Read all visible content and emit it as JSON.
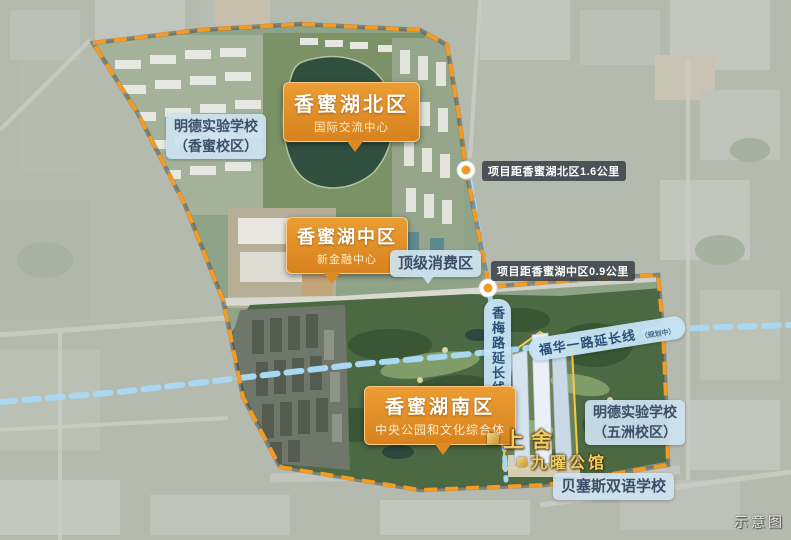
{
  "districts": {
    "north": {
      "title": "香蜜湖北区",
      "subtitle": "国际交流中心"
    },
    "middle": {
      "title": "香蜜湖中区",
      "subtitle": "新金融中心"
    },
    "south": {
      "title": "香蜜湖南区",
      "subtitle": "中央公园和文化综合体"
    }
  },
  "schools": {
    "mingde_xiangmi": {
      "line1": "明德实验学校",
      "line2": "（香蜜校区）"
    },
    "mingde_wuzhou": {
      "line1": "明德实验学校",
      "line2": "（五洲校区）"
    },
    "basis": {
      "name": "贝塞斯双语学校"
    }
  },
  "pois": {
    "consumption": {
      "name": "顶级消费区"
    }
  },
  "distances": {
    "north": {
      "text": "项目距香蜜湖北区1.6公里"
    },
    "middle": {
      "text": "项目距香蜜湖中区0.9公里"
    }
  },
  "roads": {
    "xiangmei": {
      "name": "香梅路延长线",
      "note": "（规划中）"
    },
    "fuhua": {
      "name": "福华一路延长线",
      "note": "（规划中）"
    }
  },
  "project": {
    "brand": "上舍",
    "name": "九曜公馆"
  },
  "watermark": "示意图",
  "colors": {
    "boundary_orange": "#F59A23",
    "planned_road_blue": "#A9D8F2",
    "district_callout_bg": "#E08F28",
    "info_label_bg": "#CDE2F0",
    "distance_badge_bg": "#39434B",
    "project_gold": "#EDC764"
  }
}
